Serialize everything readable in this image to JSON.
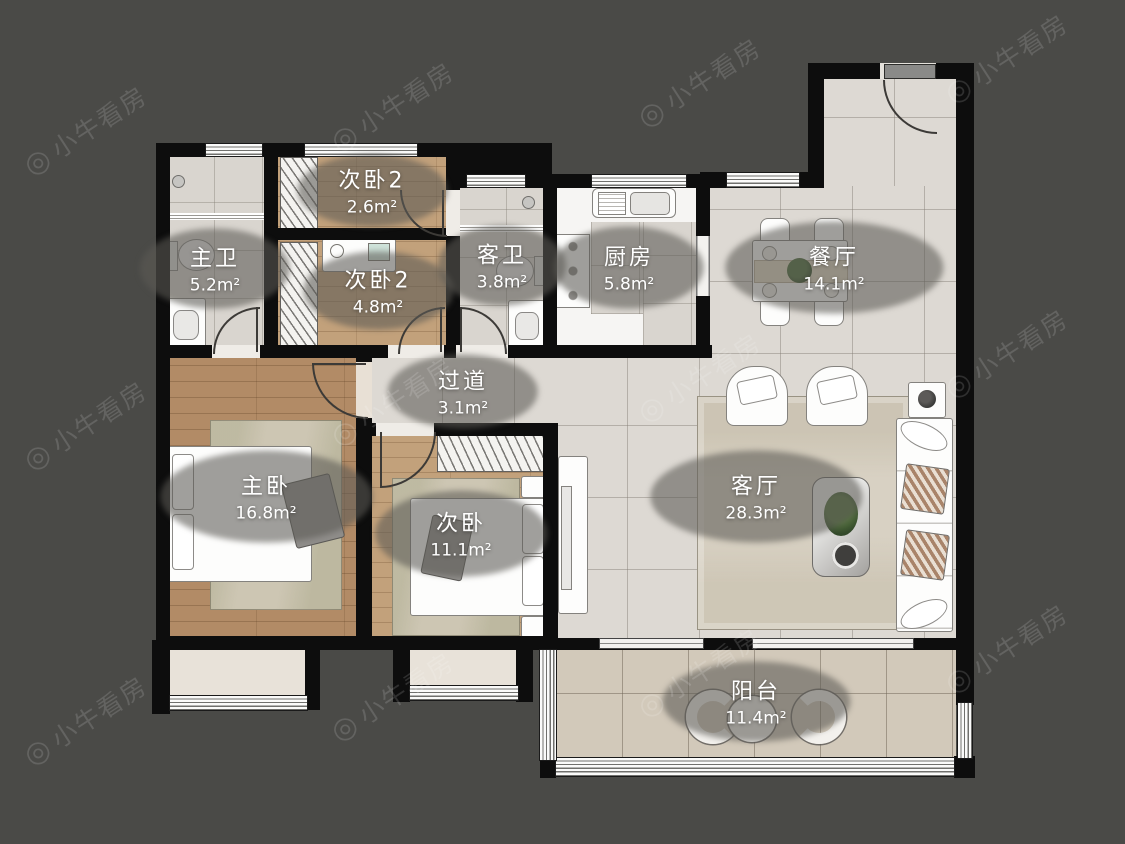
{
  "watermark": {
    "icon": "◎",
    "text": "小牛看房"
  },
  "rooms": [
    {
      "name": "主卫",
      "area": "5.2m²"
    },
    {
      "name": "次卧2",
      "area": "2.6m²"
    },
    {
      "name": "次卧2",
      "area": "4.8m²"
    },
    {
      "name": "客卫",
      "area": "3.8m²"
    },
    {
      "name": "厨房",
      "area": "5.8m²"
    },
    {
      "name": "餐厅",
      "area": "14.1m²"
    },
    {
      "name": "过道",
      "area": "3.1m²"
    },
    {
      "name": "主卧",
      "area": "16.8m²"
    },
    {
      "name": "次卧",
      "area": "11.1m²"
    },
    {
      "name": "客厅",
      "area": "28.3m²"
    },
    {
      "name": "阳台",
      "area": "11.4m²"
    }
  ],
  "colors": {
    "background": "#4a4a47",
    "wall": "#0d0d0d",
    "wood_master": "#b28b66",
    "wood_secondary": "#c2a17b",
    "tile": "#ddd9d3",
    "balcony_tile": "#d2c9ba",
    "label_text": "#ffffff"
  }
}
